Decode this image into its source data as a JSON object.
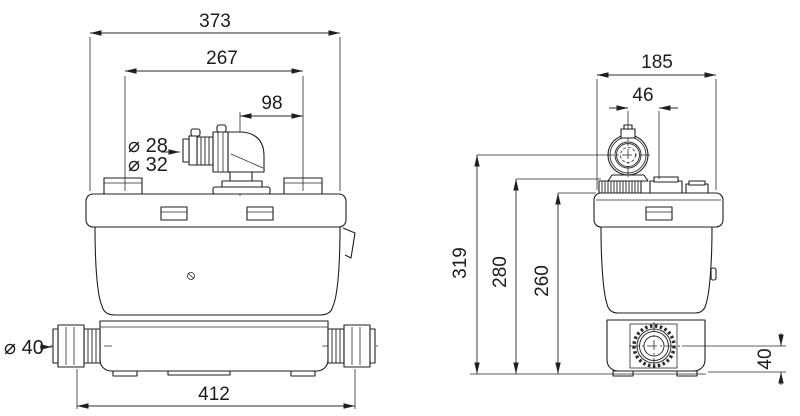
{
  "colors": {
    "line": "#1f1f1f",
    "background": "#ffffff"
  },
  "front_view": {
    "overall_width": "373",
    "inner_width": "267",
    "outlet_offset": "98",
    "outlet_dia_small": "⌀ 28",
    "outlet_dia_large": "⌀ 32",
    "inlet_dia": "⌀ 40",
    "base_width": "412"
  },
  "side_view": {
    "width": "185",
    "outlet_center_offset": "46",
    "height_to_outlet_center": "319",
    "height_to_collar": "280",
    "height_to_lid": "260",
    "inlet_center_height": "40"
  }
}
